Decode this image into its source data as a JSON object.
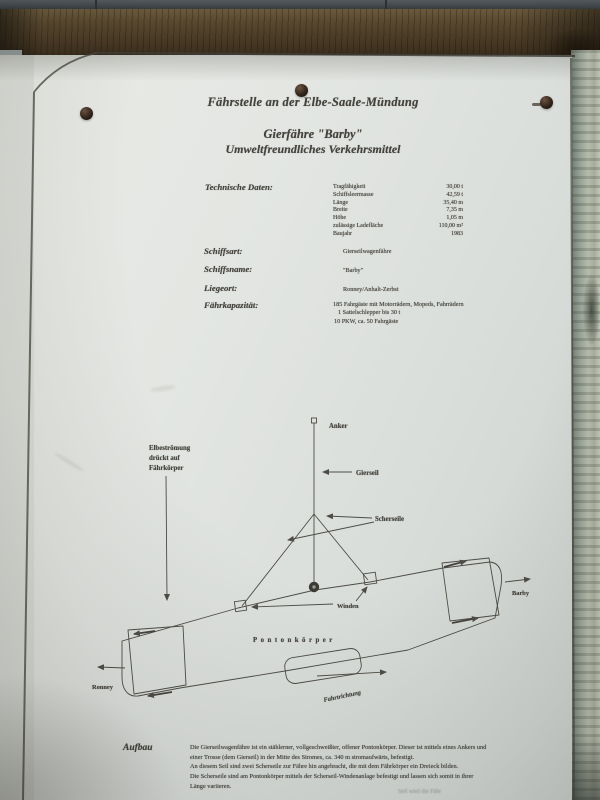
{
  "sign": {
    "title": "Fährstelle an der Elbe-Saale-Mündung",
    "subtitle_line1": "Gierfähre \"Barby\"",
    "subtitle_line2": "Umweltfreundliches Verkehrsmittel",
    "technische_daten": {
      "label": "Technische Daten:",
      "rows": [
        {
          "name": "Tragfähigkeit",
          "value": "30,00 t"
        },
        {
          "name": "Schiffsleermasse",
          "value": "42,59 t"
        },
        {
          "name": "Länge",
          "value": "35,40 m"
        },
        {
          "name": "Breite",
          "value": "7,35 m"
        },
        {
          "name": "Höhe",
          "value": "1,05 m"
        },
        {
          "name": "zulässige Ladefläche",
          "value": "110,00 m²"
        },
        {
          "name": "Baujahr",
          "value": "1983"
        }
      ]
    },
    "fields": [
      {
        "label": "Schiffsart:",
        "value": "Gierseilwagenfähre"
      },
      {
        "label": "Schiffsname:",
        "value": "\"Barby\""
      },
      {
        "label": "Liegeort:",
        "value": "Ronney/Anhalt-Zerbst"
      },
      {
        "label": "Fährkapazität:"
      }
    ],
    "kapazitaet_lines": [
      "185 Fahrgäste mit Motorrädern, Mopeds, Fahrrädern",
      "1 Sattelschlepper bis 30 t",
      "10 PKW, ca. 50 Fahrgäste"
    ],
    "diagram": {
      "anker": "Anker",
      "gierseil": "Gierseil",
      "scherseile": "Scherseile",
      "winden": "Winden",
      "pontonkoerper": "Pontonkörper",
      "stroemung_line1": "Elbeströmung",
      "stroemung_line2": "drückt auf",
      "stroemung_line3": "Fährkörper",
      "ronney": "Ronney",
      "barby": "Barby",
      "fahrtrichtung": "Fahrtrichtung"
    },
    "aufbau": {
      "label": "Aufbau",
      "lines": [
        "Die Gierseilwagenfähre ist ein stählerner, vollgeschweißter, offener Pontonkörper. Dieser ist mittels eines Ankers und",
        "einer Trosse (dem Gierseil) in der Mitte des Stromes, ca. 340 m stromaufwärts, befestigt.",
        "An diesem Seil sind zwei Scherseile zur Fähre hin angebracht, die mit dem Fährkörper ein Dreieck bilden.",
        "Die Scherseile sind am Pontonkörper mittels der Scherseil-Windenanlage befestigt und lassen sich somit in ihrer",
        "Länge variieren."
      ],
      "cutoff_fragment": "Seil wird die Fähr"
    },
    "colors": {
      "ink": "#44423c",
      "paper": "#e2e5e1",
      "beam": "#4c3d27"
    }
  }
}
